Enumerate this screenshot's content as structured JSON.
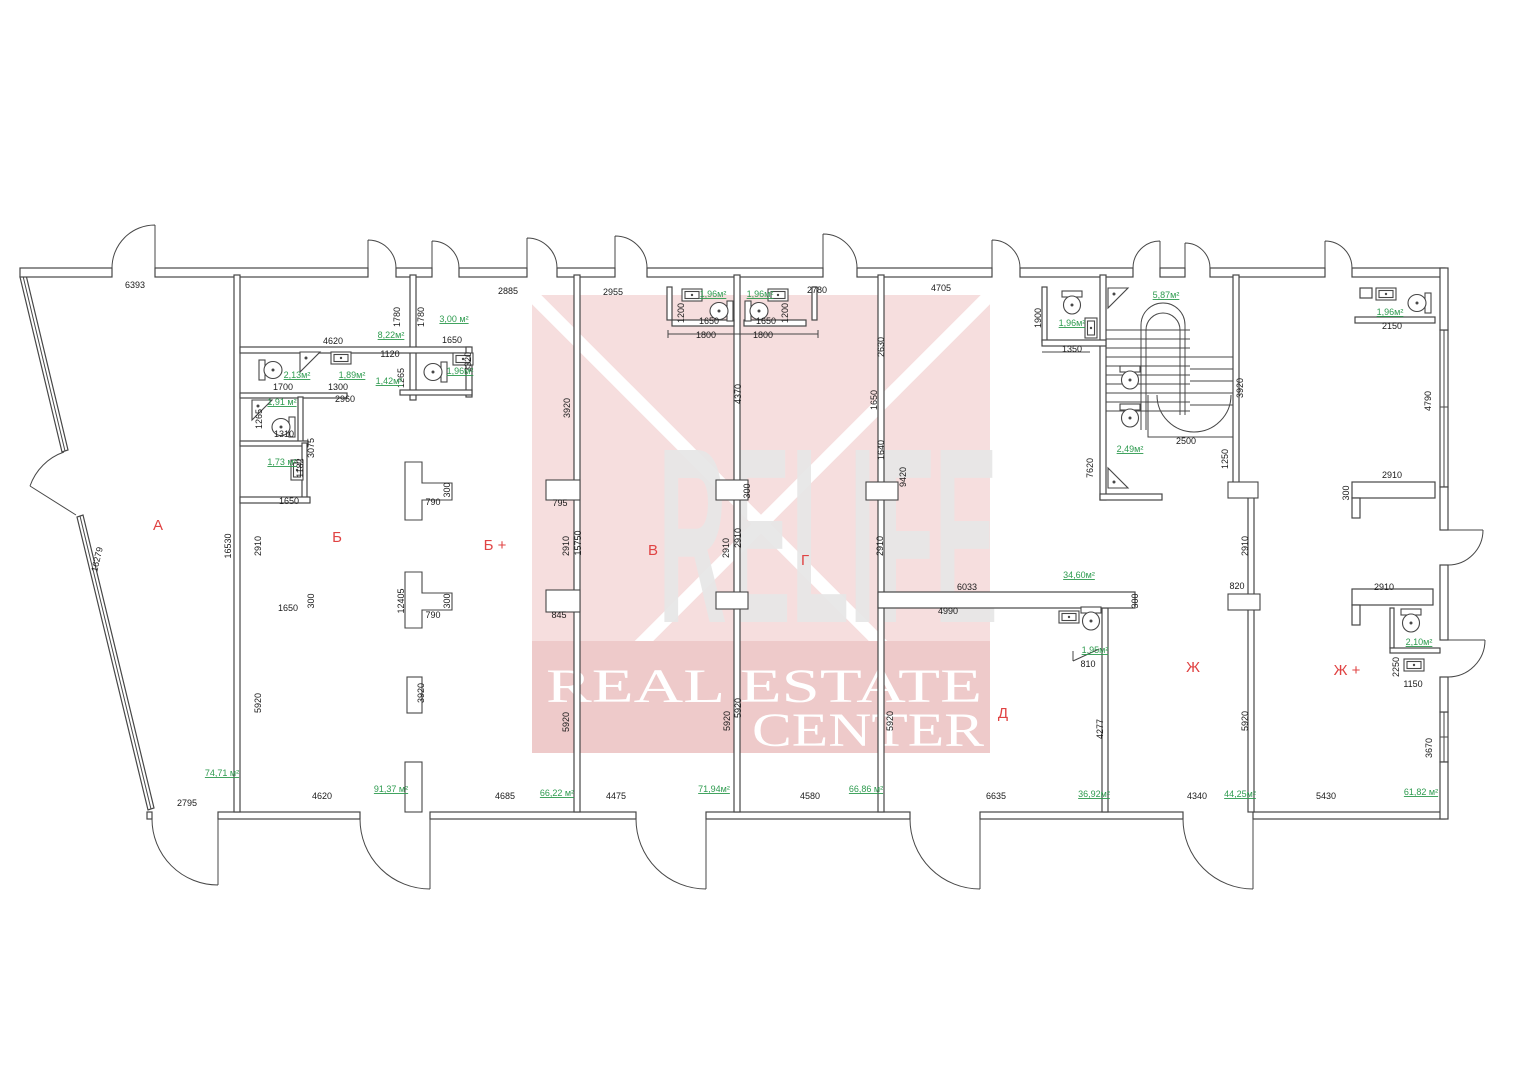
{
  "watermark": {
    "brand": "RELIFE",
    "line1": "REAL ESTATE",
    "line2": "CENTER"
  },
  "colors": {
    "wall": "#474747",
    "dim": "#1a1a1a",
    "area": "#2e9b4f",
    "room": "#e04343",
    "wm_pink": "#f6dede",
    "wm_band": "#eecaca",
    "wm_letter": "#e7e7e7"
  },
  "plan": {
    "rooms": [
      {
        "t": "А",
        "x": 158,
        "y": 530
      },
      {
        "t": "Б",
        "x": 337,
        "y": 542
      },
      {
        "t": "Б +",
        "x": 495,
        "y": 550
      },
      {
        "t": "В",
        "x": 653,
        "y": 555
      },
      {
        "t": "Г",
        "x": 805,
        "y": 565
      },
      {
        "t": "Д",
        "x": 1003,
        "y": 718
      },
      {
        "t": "Ж",
        "x": 1193,
        "y": 672
      },
      {
        "t": "Ж +",
        "x": 1347,
        "y": 675
      }
    ],
    "areas": [
      {
        "t": "8,22м²",
        "x": 391,
        "y": 338
      },
      {
        "t": "3,00 м²",
        "x": 454,
        "y": 322
      },
      {
        "t": "2,13м²",
        "x": 297,
        "y": 378
      },
      {
        "t": "1,89м²",
        "x": 352,
        "y": 378
      },
      {
        "t": "1,42м²",
        "x": 389,
        "y": 384
      },
      {
        "t": "1,96м²",
        "x": 460,
        "y": 374
      },
      {
        "t": "1,91 м²",
        "x": 282,
        "y": 405
      },
      {
        "t": "1,73 м²",
        "x": 282,
        "y": 465
      },
      {
        "t": "74,71 м²",
        "x": 222,
        "y": 776
      },
      {
        "t": "91,37 м²",
        "x": 391,
        "y": 792
      },
      {
        "t": "66,22 м²",
        "x": 557,
        "y": 796
      },
      {
        "t": "1,96м²",
        "x": 713,
        "y": 297
      },
      {
        "t": "1,96м²",
        "x": 760,
        "y": 297
      },
      {
        "t": "71,94м²",
        "x": 714,
        "y": 792
      },
      {
        "t": "66,86 м²",
        "x": 866,
        "y": 792
      },
      {
        "t": "34,60м²",
        "x": 1079,
        "y": 578
      },
      {
        "t": "1,95м²",
        "x": 1095,
        "y": 653
      },
      {
        "t": "36,92м²",
        "x": 1094,
        "y": 797
      },
      {
        "t": "1,96м²",
        "x": 1072,
        "y": 326
      },
      {
        "t": "5,87м²",
        "x": 1166,
        "y": 298
      },
      {
        "t": "2,49м²",
        "x": 1130,
        "y": 452
      },
      {
        "t": "1,96м²",
        "x": 1390,
        "y": 315
      },
      {
        "t": "44,25м²",
        "x": 1240,
        "y": 797
      },
      {
        "t": "2,10м²",
        "x": 1419,
        "y": 645
      },
      {
        "t": "61,82 м²",
        "x": 1421,
        "y": 795
      }
    ],
    "dimensions": [
      {
        "t": "6393",
        "x": 135,
        "y": 288
      },
      {
        "t": "4620",
        "x": 333,
        "y": 344
      },
      {
        "t": "1120",
        "x": 390,
        "y": 357
      },
      {
        "t": "1780",
        "x": 400,
        "y": 317,
        "r": -90
      },
      {
        "t": "1780",
        "x": 424,
        "y": 317,
        "r": -90
      },
      {
        "t": "1650",
        "x": 452,
        "y": 343
      },
      {
        "t": "3320",
        "x": 471,
        "y": 362,
        "r": -90
      },
      {
        "t": "1700",
        "x": 283,
        "y": 390
      },
      {
        "t": "1300",
        "x": 338,
        "y": 390
      },
      {
        "t": "2960",
        "x": 345,
        "y": 402
      },
      {
        "t": "1265",
        "x": 262,
        "y": 419,
        "r": -90
      },
      {
        "t": "1265",
        "x": 404,
        "y": 378,
        "r": -90
      },
      {
        "t": "1310",
        "x": 284,
        "y": 437
      },
      {
        "t": "3075",
        "x": 314,
        "y": 448,
        "r": -90
      },
      {
        "t": "1182",
        "x": 303,
        "y": 468,
        "r": -90
      },
      {
        "t": "1650",
        "x": 289,
        "y": 504
      },
      {
        "t": "1650",
        "x": 288,
        "y": 611
      },
      {
        "t": "300",
        "x": 314,
        "y": 601,
        "r": -90
      },
      {
        "t": "16530",
        "x": 231,
        "y": 546,
        "r": -90
      },
      {
        "t": "2910",
        "x": 261,
        "y": 546,
        "r": -90
      },
      {
        "t": "5920",
        "x": 261,
        "y": 703,
        "r": -90
      },
      {
        "t": "2795",
        "x": 187,
        "y": 806
      },
      {
        "t": "4620",
        "x": 322,
        "y": 799
      },
      {
        "t": "16279",
        "x": 100,
        "y": 560,
        "r": -77
      },
      {
        "t": "790",
        "x": 433,
        "y": 505
      },
      {
        "t": "300",
        "x": 450,
        "y": 490,
        "r": -90
      },
      {
        "t": "790",
        "x": 433,
        "y": 618
      },
      {
        "t": "300",
        "x": 450,
        "y": 601,
        "r": -90
      },
      {
        "t": "12405",
        "x": 404,
        "y": 601,
        "r": -90
      },
      {
        "t": "3920",
        "x": 424,
        "y": 693,
        "r": -90
      },
      {
        "t": "4685",
        "x": 505,
        "y": 799
      },
      {
        "t": "4475",
        "x": 616,
        "y": 799
      },
      {
        "t": "2885",
        "x": 508,
        "y": 294
      },
      {
        "t": "2955",
        "x": 613,
        "y": 295
      },
      {
        "t": "3920",
        "x": 570,
        "y": 408,
        "r": -90
      },
      {
        "t": "795",
        "x": 560,
        "y": 506
      },
      {
        "t": "2910",
        "x": 569,
        "y": 546,
        "r": -90
      },
      {
        "t": "15750",
        "x": 581,
        "y": 543,
        "r": -90
      },
      {
        "t": "845",
        "x": 559,
        "y": 618
      },
      {
        "t": "5920",
        "x": 569,
        "y": 722,
        "r": -90
      },
      {
        "t": "1200",
        "x": 684,
        "y": 313,
        "r": -90
      },
      {
        "t": "1650",
        "x": 709,
        "y": 324
      },
      {
        "t": "1800",
        "x": 706,
        "y": 338
      },
      {
        "t": "1650",
        "x": 766,
        "y": 324
      },
      {
        "t": "1800",
        "x": 763,
        "y": 338
      },
      {
        "t": "1200",
        "x": 788,
        "y": 313,
        "r": -90
      },
      {
        "t": "2780",
        "x": 817,
        "y": 293
      },
      {
        "t": "4370",
        "x": 741,
        "y": 394,
        "r": -90
      },
      {
        "t": "300",
        "x": 750,
        "y": 491,
        "r": -90
      },
      {
        "t": "2910",
        "x": 729,
        "y": 548,
        "r": -90
      },
      {
        "t": "2910",
        "x": 741,
        "y": 538,
        "r": -90
      },
      {
        "t": "5920",
        "x": 730,
        "y": 721,
        "r": -90
      },
      {
        "t": "5920",
        "x": 741,
        "y": 708,
        "r": -90
      },
      {
        "t": "4580",
        "x": 810,
        "y": 799
      },
      {
        "t": "4705",
        "x": 941,
        "y": 291
      },
      {
        "t": "2630",
        "x": 884,
        "y": 347,
        "r": -90
      },
      {
        "t": "1650",
        "x": 877,
        "y": 400,
        "r": -90
      },
      {
        "t": "1640",
        "x": 884,
        "y": 450,
        "r": -90
      },
      {
        "t": "9420",
        "x": 906,
        "y": 477,
        "r": -90
      },
      {
        "t": "2910",
        "x": 883,
        "y": 546,
        "r": -90
      },
      {
        "t": "6033",
        "x": 967,
        "y": 590
      },
      {
        "t": "4990",
        "x": 948,
        "y": 614
      },
      {
        "t": "300",
        "x": 1138,
        "y": 601,
        "r": -90
      },
      {
        "t": "5920",
        "x": 893,
        "y": 721,
        "r": -90
      },
      {
        "t": "6635",
        "x": 996,
        "y": 799
      },
      {
        "t": "810",
        "x": 1088,
        "y": 667
      },
      {
        "t": "4277",
        "x": 1103,
        "y": 729,
        "r": -90
      },
      {
        "t": "1900",
        "x": 1041,
        "y": 318,
        "r": -90
      },
      {
        "t": "1350",
        "x": 1072,
        "y": 352
      },
      {
        "t": "2500",
        "x": 1186,
        "y": 444
      },
      {
        "t": "1250",
        "x": 1228,
        "y": 459,
        "r": -90
      },
      {
        "t": "3920",
        "x": 1243,
        "y": 388,
        "r": -90
      },
      {
        "t": "7620",
        "x": 1093,
        "y": 468,
        "r": -90
      },
      {
        "t": "820",
        "x": 1237,
        "y": 589
      },
      {
        "t": "2910",
        "x": 1248,
        "y": 546,
        "r": -90
      },
      {
        "t": "5920",
        "x": 1248,
        "y": 721,
        "r": -90
      },
      {
        "t": "4340",
        "x": 1197,
        "y": 799
      },
      {
        "t": "2150",
        "x": 1392,
        "y": 329
      },
      {
        "t": "4790",
        "x": 1431,
        "y": 401,
        "r": -90
      },
      {
        "t": "2910",
        "x": 1392,
        "y": 478
      },
      {
        "t": "300",
        "x": 1349,
        "y": 493,
        "r": -90
      },
      {
        "t": "2910",
        "x": 1384,
        "y": 590
      },
      {
        "t": "2250",
        "x": 1399,
        "y": 667,
        "r": -90
      },
      {
        "t": "1150",
        "x": 1413,
        "y": 687
      },
      {
        "t": "3670",
        "x": 1432,
        "y": 748,
        "r": -90
      },
      {
        "t": "5430",
        "x": 1326,
        "y": 799
      }
    ]
  }
}
